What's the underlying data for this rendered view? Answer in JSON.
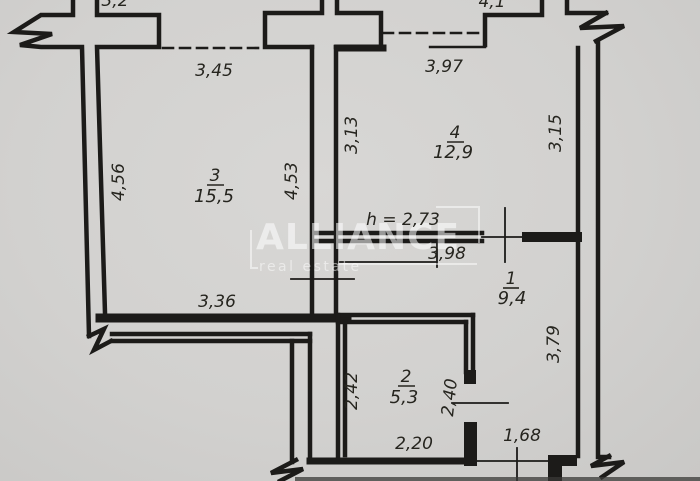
{
  "colors": {
    "paper": "#d2d1cf",
    "ink": "#1c1b19",
    "watermark": "rgba(255,255,255,0.55)"
  },
  "watermark": {
    "brand": "ALLIANCE",
    "tagline": "real estate"
  },
  "rooms": [
    {
      "id": "3",
      "area": "15,5"
    },
    {
      "id": "4",
      "area": "12,9"
    },
    {
      "id": "1",
      "area": "9,4"
    },
    {
      "id": "2",
      "area": "5,3"
    }
  ],
  "dimensions": {
    "room3_top": "3,45",
    "room4_top": "3,97",
    "room3_left": "4,56",
    "room3_right": "4,53",
    "room3_bottom": "3,36",
    "room4_left": "3,13",
    "room4_right": "3,15",
    "ceiling_height": "h = 2,73",
    "hall_top": "3,98",
    "hall_right": "3,79",
    "room2_left": "2,42",
    "room2_right": "2,40",
    "room2_bottom": "2,20",
    "entry_width": "1,68",
    "top_edge_left": "3,2",
    "top_edge_right": "4,1"
  }
}
